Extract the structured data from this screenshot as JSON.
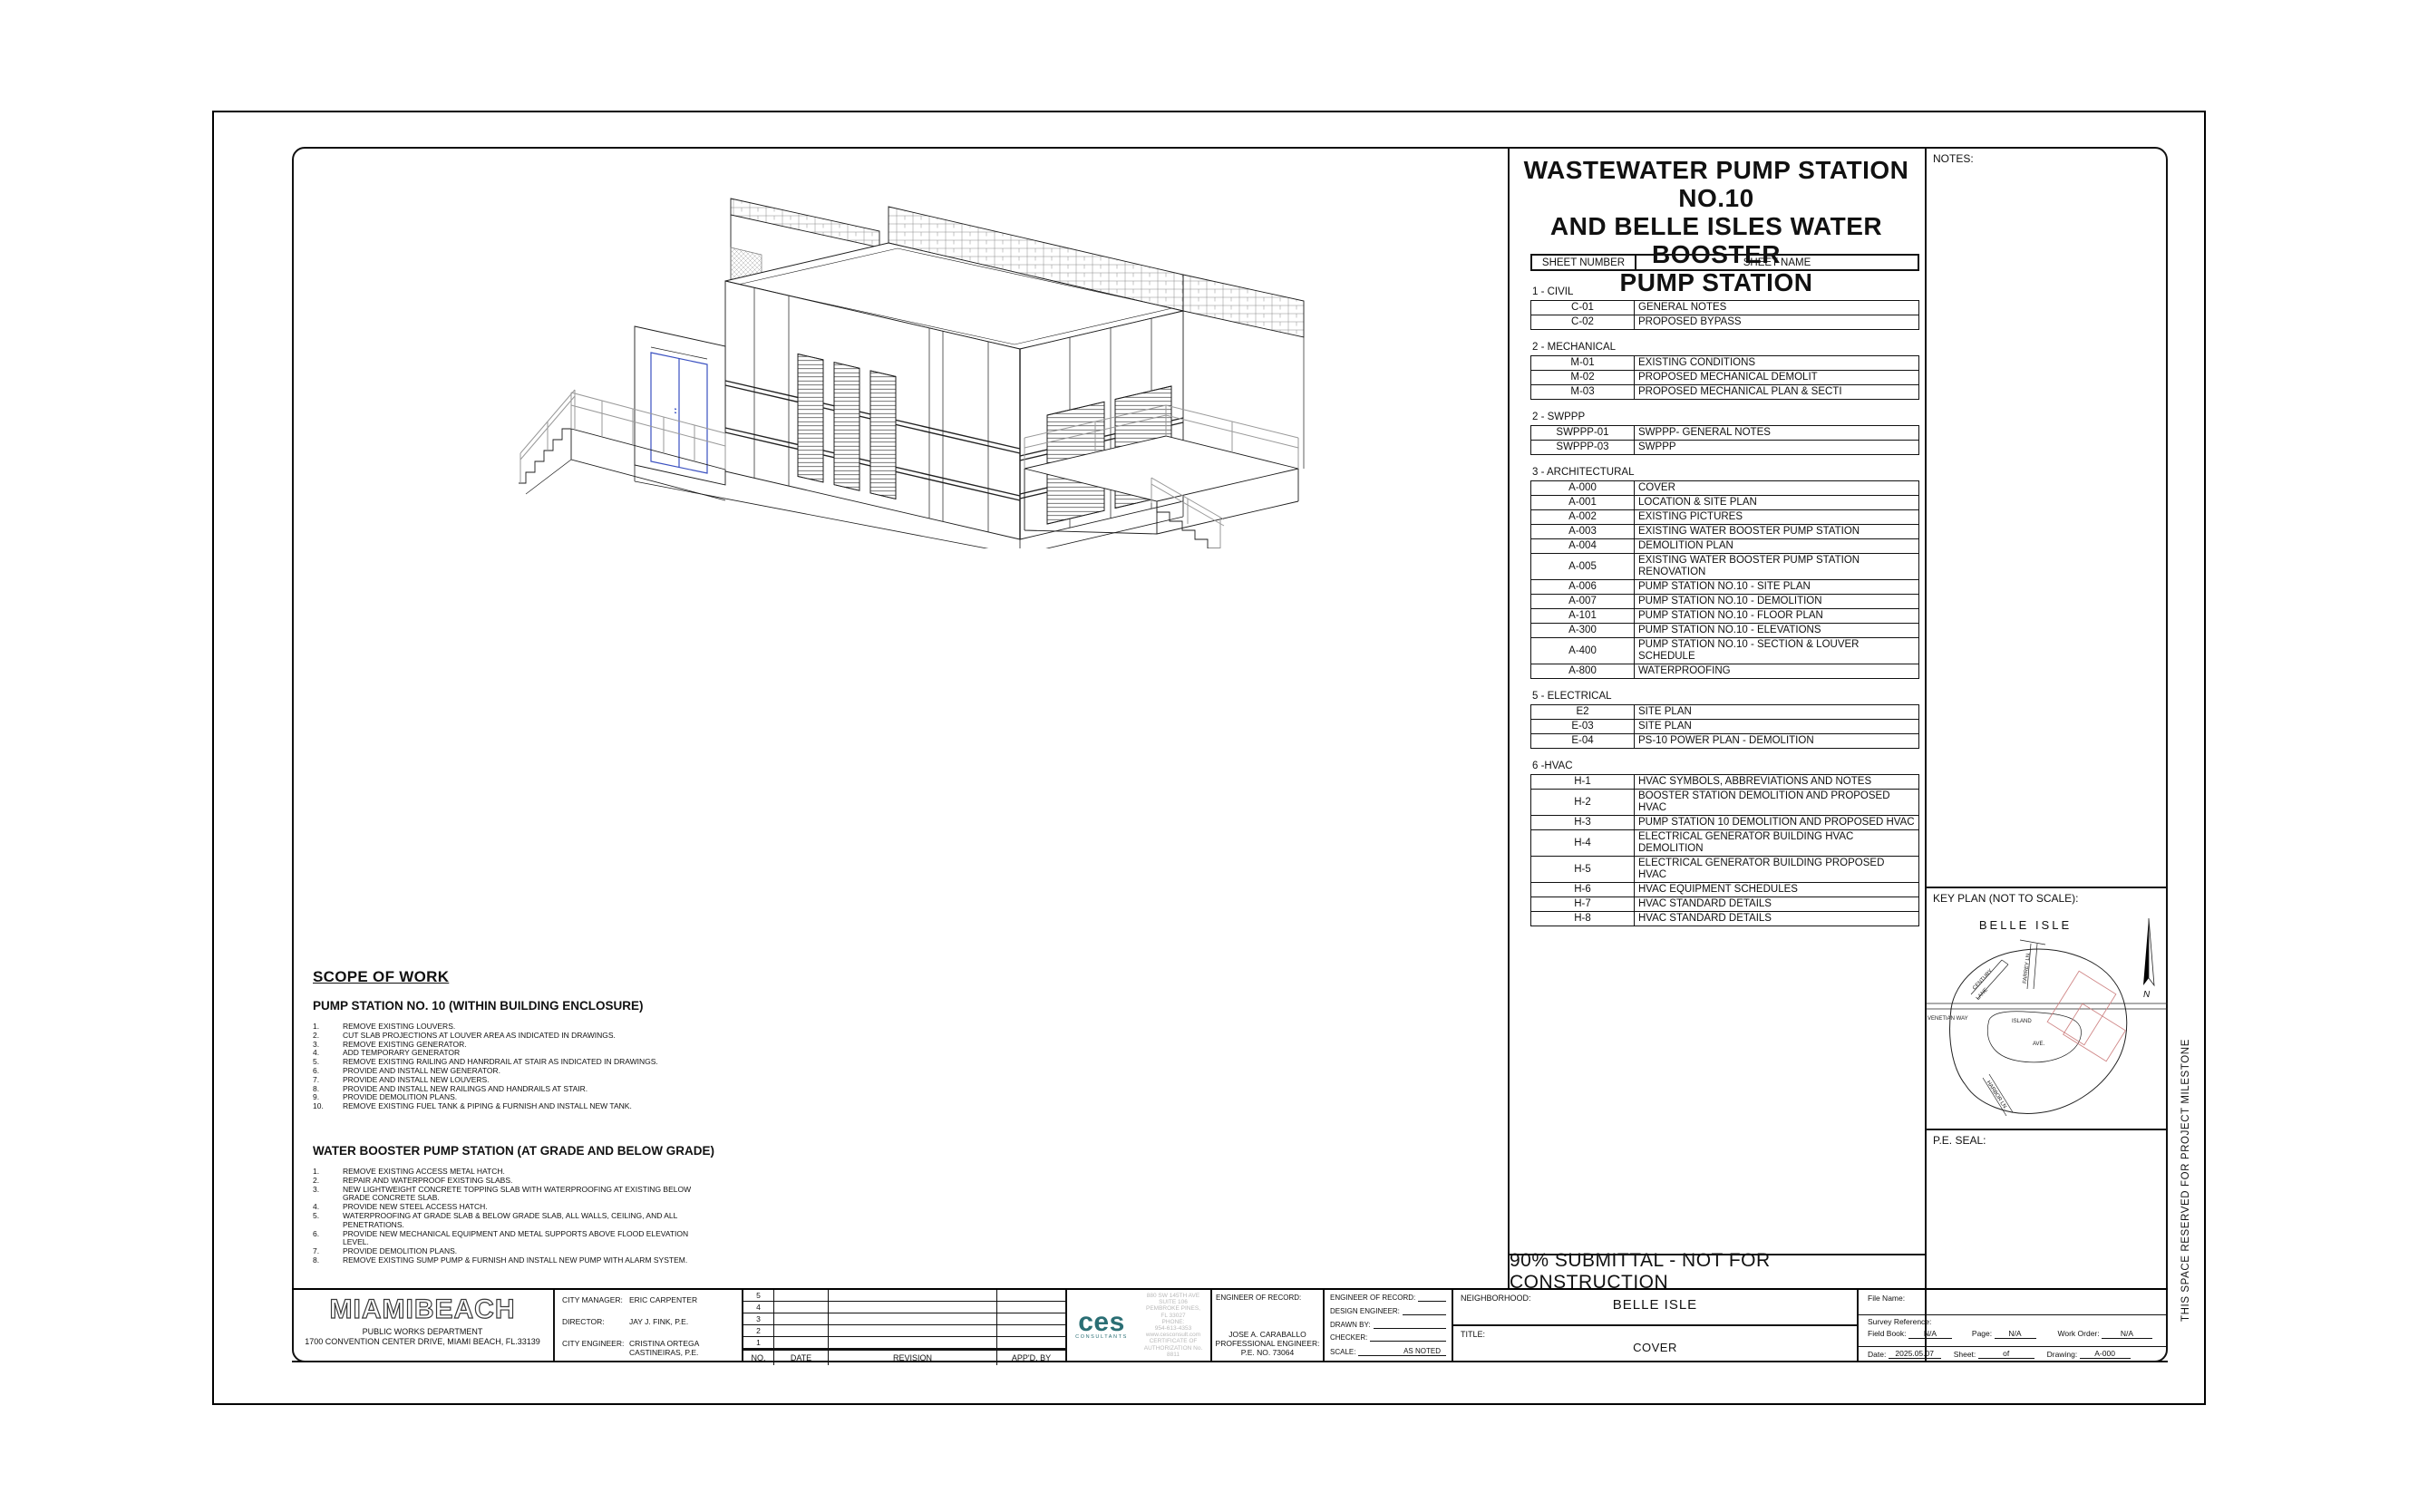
{
  "project_title": {
    "line1": "WASTEWATER PUMP STATION NO.10",
    "line2": "AND BELLE ISLES WATER BOOSTER",
    "line3": "PUMP STATION"
  },
  "right_column": {
    "notes_label": "NOTES:",
    "keyplan_label": "KEY PLAN (NOT TO SCALE):",
    "peseal_label": "P.E. SEAL:",
    "milestone": "THIS SPACE RESERVED FOR PROJECT MILESTONE",
    "map": {
      "title": "BELLE ISLE",
      "venetian": "VENETIAN WAY",
      "island": "ISLAND",
      "ave": "AVE.",
      "century": "CENTURY",
      "lane": "LANE",
      "farrey": "FARREY LN.",
      "harbor": "HARBOR LN.",
      "north": "N"
    }
  },
  "sheet_index": {
    "header": {
      "col1": "SHEET NUMBER",
      "col2": "SHEET NAME"
    },
    "sections": [
      {
        "label": "1 - CIVIL",
        "rows": [
          {
            "num": "C-01",
            "name": "GENERAL NOTES"
          },
          {
            "num": "C-02",
            "name": "PROPOSED BYPASS"
          }
        ]
      },
      {
        "label": "2 - MECHANICAL",
        "rows": [
          {
            "num": "M-01",
            "name": "EXISTING CONDITIONS"
          },
          {
            "num": "M-02",
            "name": "PROPOSED MECHANICAL DEMOLIT"
          },
          {
            "num": "M-03",
            "name": "PROPOSED MECHANICAL  PLAN & SECTI"
          }
        ]
      },
      {
        "label": "2 - SWPPP",
        "rows": [
          {
            "num": "SWPPP-01",
            "name": "SWPPP- GENERAL NOTES"
          },
          {
            "num": "SWPPP-03",
            "name": "SWPPP"
          }
        ]
      },
      {
        "label": "3 - ARCHITECTURAL",
        "rows": [
          {
            "num": "A-000",
            "name": "COVER"
          },
          {
            "num": "A-001",
            "name": "LOCATION &  SITE PLAN"
          },
          {
            "num": "A-002",
            "name": "EXISTING PICTURES"
          },
          {
            "num": "A-003",
            "name": "EXISTING WATER BOOSTER PUMP STATION"
          },
          {
            "num": "A-004",
            "name": "DEMOLITION PLAN"
          },
          {
            "num": "A-005",
            "name": "EXISTING  WATER BOOSTER PUMP STATION RENOVATION"
          },
          {
            "num": "A-006",
            "name": "PUMP STATION NO.10 - SITE PLAN"
          },
          {
            "num": "A-007",
            "name": "PUMP STATION NO.10 - DEMOLITION"
          },
          {
            "num": "A-101",
            "name": "PUMP STATION NO.10 - FLOOR PLAN"
          },
          {
            "num": "A-300",
            "name": "PUMP STATION NO.10 - ELEVATIONS"
          },
          {
            "num": "A-400",
            "name": "PUMP STATION NO.10 - SECTION & LOUVER SCHEDULE"
          },
          {
            "num": "A-800",
            "name": "WATERPROOFING"
          }
        ]
      },
      {
        "label": "5 - ELECTRICAL",
        "rows": [
          {
            "num": "E2",
            "name": "SITE PLAN"
          },
          {
            "num": "E-03",
            "name": "SITE PLAN"
          },
          {
            "num": "E-04",
            "name": "PS-10 POWER PLAN - DEMOLITION"
          }
        ]
      },
      {
        "label": "6 -HVAC",
        "rows": [
          {
            "num": "H-1",
            "name": "HVAC SYMBOLS, ABBREVIATIONS AND NOTES"
          },
          {
            "num": "H-2",
            "name": "BOOSTER STATION DEMOLITION AND PROPOSED HVAC"
          },
          {
            "num": "H-3",
            "name": "PUMP STATION 10 DEMOLITION AND PROPOSED HVAC"
          },
          {
            "num": "H-4",
            "name": "ELECTRICAL GENERATOR BUILDING HVAC DEMOLITION"
          },
          {
            "num": "H-5",
            "name": "ELECTRICAL GENERATOR BUILDING PROPOSED HVAC"
          },
          {
            "num": "H-6",
            "name": "HVAC EQUIPMENT SCHEDULES"
          },
          {
            "num": "H-7",
            "name": "HVAC STANDARD DETAILS"
          },
          {
            "num": "H-8",
            "name": "HVAC STANDARD DETAILS"
          }
        ]
      }
    ]
  },
  "scope": {
    "heading": "SCOPE OF WORK",
    "ps10": {
      "heading": "PUMP STATION NO. 10 (WITHIN BUILDING ENCLOSURE)",
      "items": [
        "REMOVE EXISTING LOUVERS.",
        "CUT SLAB PROJECTIONS AT LOUVER AREA AS INDICATED IN DRAWINGS.",
        "REMOVE EXISTING GENERATOR.",
        "ADD TEMPORARY GENERATOR",
        "REMOVE EXISTING RAILING AND HANRDRAIL AT STAIR AS INDICATED IN DRAWINGS.",
        "PROVIDE AND INSTALL NEW GENERATOR.",
        "PROVIDE AND INSTALL NEW LOUVERS.",
        "PROVIDE AND INSTALL NEW RAILINGS AND HANDRAILS AT STAIR.",
        "PROVIDE DEMOLITION PLANS.",
        "REMOVE EXISTING FUEL TANK & PIPING & FURNISH AND INSTALL NEW TANK."
      ]
    },
    "booster": {
      "heading": "WATER BOOSTER PUMP STATION (AT GRADE AND BELOW GRADE)",
      "items": [
        "REMOVE EXISTING ACCESS METAL HATCH.",
        "REPAIR AND WATERPROOF EXISTING SLABS.",
        "NEW LIGHTWEIGHT CONCRETE TOPPING SLAB WITH WATERPROOFING AT EXISTING  BELOW GRADE CONCRETE SLAB.",
        "PROVIDE NEW STEEL ACCESS HATCH.",
        "WATERPROOFING AT GRADE SLAB & BELOW GRADE SLAB, ALL WALLS, CEILING, AND ALL PENETRATIONS.",
        "PROVIDE NEW MECHANICAL EQUIPMENT AND METAL SUPPORTS ABOVE FLOOD ELEVATION LEVEL.",
        "PROVIDE DEMOLITION PLANS.",
        "REMOVE EXISTING SUMP PUMP & FURNISH AND INSTALL NEW PUMP WITH ALARM SYSTEM."
      ]
    }
  },
  "submittal_text": "90% SUBMITTAL  -  NOT FOR CONSTRUCTION",
  "title_block": {
    "agency": {
      "logo1": "MIAMI",
      "logo2": "BEACH",
      "dept": "PUBLIC WORKS DEPARTMENT",
      "address": "1700 CONVENTION CENTER DRIVE, MIAMI BEACH, FL.33139"
    },
    "staff": [
      {
        "label": "CITY MANAGER:",
        "value": "ERIC CARPENTER"
      },
      {
        "label": "DIRECTOR:",
        "value": "JAY J. FINK, P.E."
      },
      {
        "label": "CITY ENGINEER:",
        "value": "CRISTINA ORTEGA CASTINEIRAS, P.E."
      }
    ],
    "revision": {
      "numbers": [
        "5",
        "4",
        "3",
        "2",
        "1"
      ],
      "headers": {
        "no": "NO.",
        "date": "DATE",
        "revision": "REVISION",
        "appd": "APP'D. BY"
      }
    },
    "ces": {
      "mark": "ces",
      "sub": "CONSULTANTS",
      "brand_color": "#2a6e74",
      "address_lines": [
        "880 SW 145TH AVE",
        "SUITE 106",
        "PEMBROKE PINES,",
        "FL  33027",
        "PHONE:",
        "954-613-4353",
        "www.cesconsult.com",
        "CERTIFICATE OF",
        "AUTHORIZATION No.",
        "8811"
      ]
    },
    "eor": {
      "label": "ENGINEER OF RECORD:",
      "name": "JOSE A. CARABALLO",
      "title": "PROFESSIONAL ENGINEER:",
      "pe_no": "P.E.   NO. 73064"
    },
    "fields": [
      {
        "label": "ENGINEER OF RECORD:",
        "value": ""
      },
      {
        "label": "DESIGN  ENGINEER:",
        "value": ""
      },
      {
        "label": "DRAWN BY:",
        "value": ""
      },
      {
        "label": "CHECKER:",
        "value": ""
      },
      {
        "label": "SCALE:",
        "value": "AS NOTED"
      }
    ],
    "neighborhood": {
      "label": "NEIGHBORHOOD:",
      "value": "BELLE ISLE"
    },
    "title": {
      "label": "TITLE:",
      "value": "COVER"
    },
    "file": {
      "file_name_label": "File Name:",
      "survey_label": "Survey Reference:",
      "field_book_label": "Field Book:",
      "field_book": "N/A",
      "page_label": "Page:",
      "page": "N/A",
      "work_order_label": "Work Order:",
      "work_order": "N/A",
      "date_label": "Date:",
      "date": "2025.05.07",
      "sheet_label": "Sheet:",
      "sheet_of": "of",
      "drawing_label": "Drawing:",
      "drawing": "A-000"
    }
  }
}
